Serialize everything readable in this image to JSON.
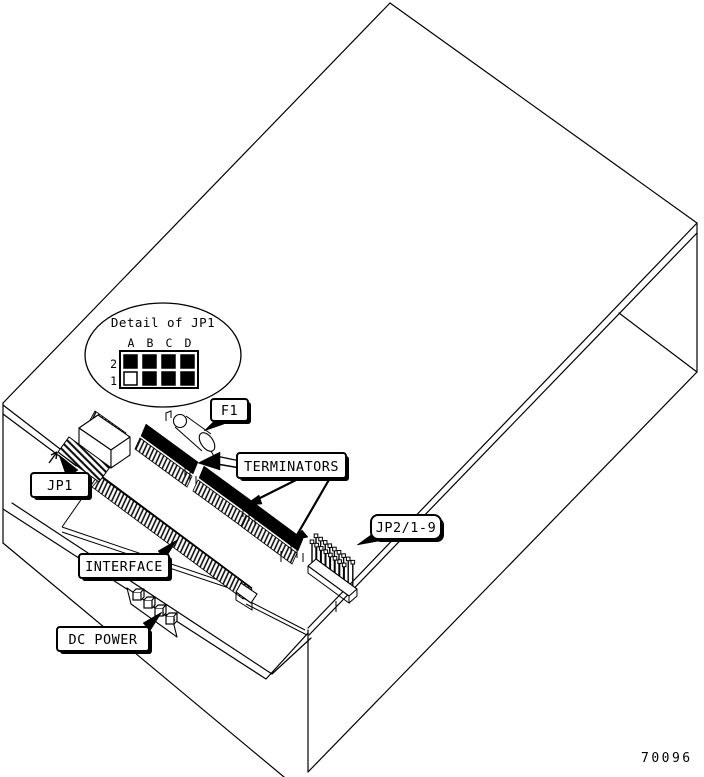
{
  "figure_number": "70096",
  "colors": {
    "ink": "#000000",
    "paper": "#ffffff"
  },
  "detail_inset": {
    "title": "Detail of JP1",
    "columns": [
      "A",
      "B",
      "C",
      "D"
    ],
    "rows": [
      {
        "label": "2",
        "jumpers": [
          "installed",
          "installed",
          "installed",
          "installed"
        ]
      },
      {
        "label": "1",
        "jumpers": [
          "open",
          "installed",
          "installed",
          "installed"
        ]
      }
    ]
  },
  "callouts": {
    "jp1": {
      "label": "JP1"
    },
    "f1": {
      "label": "F1"
    },
    "terminators": {
      "label": "TERMINATORS"
    },
    "jp2": {
      "label": "JP2/1-9"
    },
    "interface": {
      "label": "INTERFACE"
    },
    "dc_power": {
      "label": "DC POWER"
    }
  }
}
